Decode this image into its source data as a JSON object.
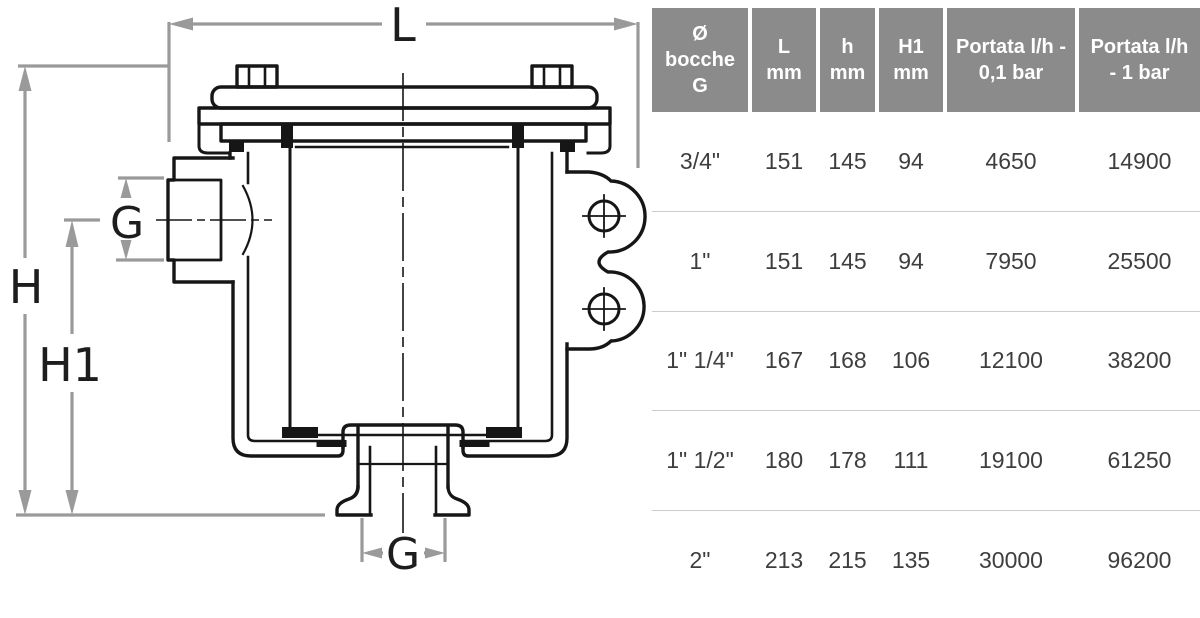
{
  "diagram": {
    "title": "water strainer technical drawing",
    "labels": {
      "overall_width": "L",
      "overall_height": "H",
      "inlet_axis_height": "H1",
      "inlet_bore": "G",
      "outlet_bore": "G"
    },
    "colors": {
      "line": "#161616",
      "dimension": "#9a9a9a",
      "label": "#1d1d1d"
    }
  },
  "table": {
    "colors": {
      "header_bg": "#8b8b8b",
      "header_text": "#ffffff",
      "cell_text": "#3e3e3e",
      "row_separator": "#cccccc"
    },
    "headers": [
      {
        "lines": [
          "Ø",
          "bocche",
          "G"
        ]
      },
      {
        "lines": [
          "L",
          "mm"
        ]
      },
      {
        "lines": [
          "h",
          "mm"
        ]
      },
      {
        "lines": [
          "H1",
          "mm"
        ]
      },
      {
        "lines": [
          "Portata l/h -",
          "0,1 bar"
        ]
      },
      {
        "lines": [
          "Portata l/h",
          "- 1 bar"
        ]
      }
    ],
    "rows": [
      [
        "3/4\"",
        "151",
        "145",
        "94",
        "4650",
        "14900"
      ],
      [
        "1\"",
        "151",
        "145",
        "94",
        "7950",
        "25500"
      ],
      [
        "1\" 1/4\"",
        "167",
        "168",
        "106",
        "12100",
        "38200"
      ],
      [
        "1\" 1/2\"",
        "180",
        "178",
        "111",
        "19100",
        "61250"
      ],
      [
        "2\"",
        "213",
        "215",
        "135",
        "30000",
        "96200"
      ]
    ]
  }
}
